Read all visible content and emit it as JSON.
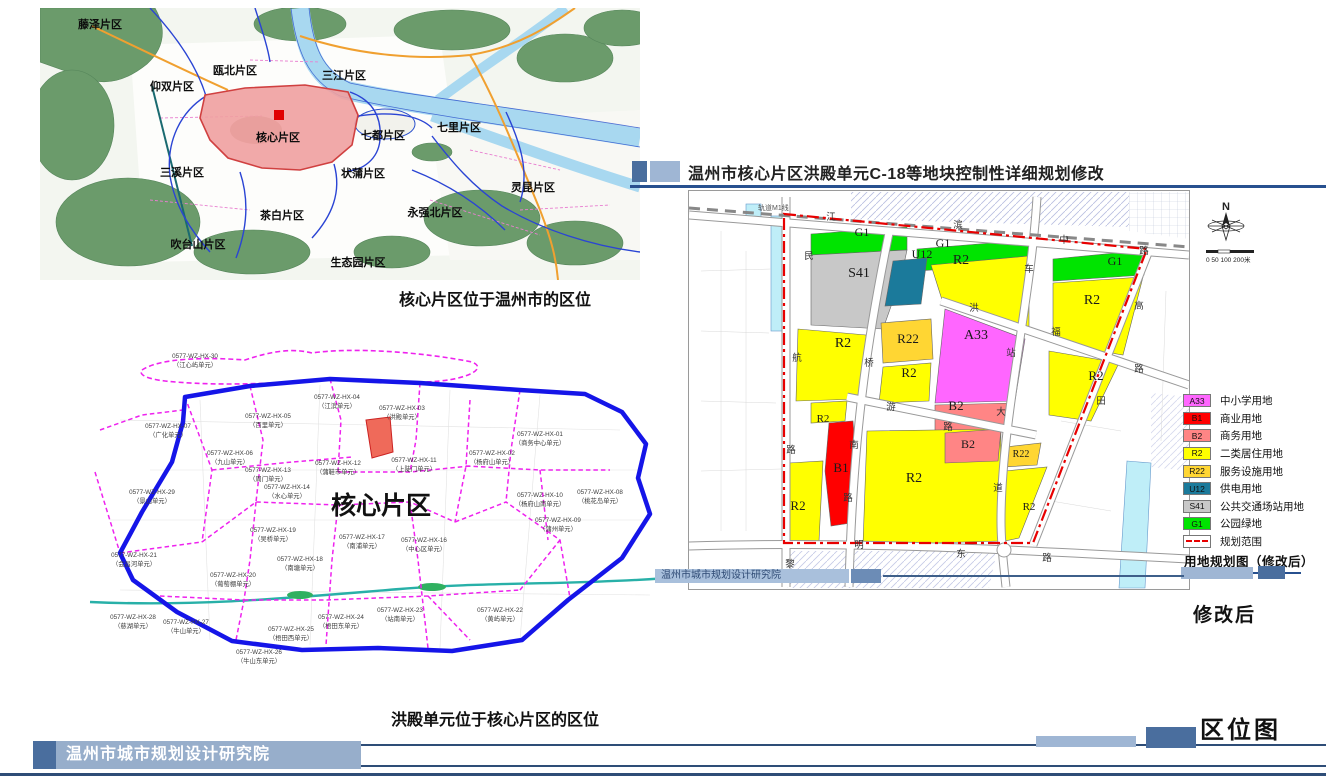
{
  "header": {
    "title": "温州市核心片区洪殿单元C-18等地块控制性详细规划修改"
  },
  "captions": {
    "region_map": "核心片区位于温州市的区位",
    "unit_map": "洪殿单元位于核心片区的区位"
  },
  "region_map": {
    "labels": [
      {
        "text": "藤泽片区",
        "x": 100,
        "y": 28
      },
      {
        "text": "瓯北片区",
        "x": 235,
        "y": 74
      },
      {
        "text": "三江片区",
        "x": 344,
        "y": 79
      },
      {
        "text": "仰双片区",
        "x": 172,
        "y": 90
      },
      {
        "text": "核心片区",
        "x": 278,
        "y": 141
      },
      {
        "text": "七都片区",
        "x": 383,
        "y": 139
      },
      {
        "text": "七里片区",
        "x": 459,
        "y": 131
      },
      {
        "text": "三溪片区",
        "x": 182,
        "y": 176
      },
      {
        "text": "状蒲片区",
        "x": 363,
        "y": 177
      },
      {
        "text": "灵昆片区",
        "x": 533,
        "y": 191
      },
      {
        "text": "茶白片区",
        "x": 282,
        "y": 219
      },
      {
        "text": "永强北片区",
        "x": 435,
        "y": 216
      },
      {
        "text": "吹台山片区",
        "x": 198,
        "y": 248
      },
      {
        "text": "生态园片区",
        "x": 358,
        "y": 266
      }
    ]
  },
  "unit_map": {
    "big_label": "核心片区",
    "units": [
      {
        "code": "0577-WZ-HX-30",
        "name": "（江心屿单元）",
        "x": 195,
        "y": 358
      },
      {
        "code": "0577-WZ-HX-07",
        "name": "（广化单元）",
        "x": 168,
        "y": 428
      },
      {
        "code": "0577-WZ-HX-05",
        "name": "（百里单元）",
        "x": 268,
        "y": 418
      },
      {
        "code": "0577-WZ-HX-04",
        "name": "（江滨单元）",
        "x": 337,
        "y": 399
      },
      {
        "code": "0577-WZ-HX-03",
        "name": "（洪殿单元）",
        "x": 402,
        "y": 410
      },
      {
        "code": "0577-WZ-HX-06",
        "name": "（九山单元）",
        "x": 230,
        "y": 455
      },
      {
        "code": "0577-WZ-HX-12",
        "name": "（蒲鞋市单元）",
        "x": 338,
        "y": 465
      },
      {
        "code": "0577-WZ-HX-11",
        "name": "（上陡门单元）",
        "x": 414,
        "y": 462
      },
      {
        "code": "0577-WZ-HX-02",
        "name": "（杨府山单元）",
        "x": 492,
        "y": 455
      },
      {
        "code": "0577-WZ-HX-01",
        "name": "（商务中心单元）",
        "x": 540,
        "y": 436
      },
      {
        "code": "0577-WZ-HX-10",
        "name": "（杨府山南单元）",
        "x": 540,
        "y": 497
      },
      {
        "code": "0577-WZ-HX-08",
        "name": "（桃花岛单元）",
        "x": 600,
        "y": 494
      },
      {
        "code": "0577-WZ-HX-09",
        "name": "（蒲州单元）",
        "x": 558,
        "y": 522
      },
      {
        "code": "0577-WZ-HX-13",
        "name": "（周门单元）",
        "x": 268,
        "y": 472
      },
      {
        "code": "0577-WZ-HX-14",
        "name": "（水心单元）",
        "x": 287,
        "y": 489
      },
      {
        "code": "0577-WZ-HX-29",
        "name": "（景山单元）",
        "x": 152,
        "y": 494
      },
      {
        "code": "0577-WZ-HX-21",
        "name": "（会昌河单元）",
        "x": 134,
        "y": 557
      },
      {
        "code": "0577-WZ-HX-19",
        "name": "（吴桥单元）",
        "x": 273,
        "y": 532
      },
      {
        "code": "0577-WZ-HX-17",
        "name": "（南浦单元）",
        "x": 362,
        "y": 539
      },
      {
        "code": "0577-WZ-HX-16",
        "name": "（中心区单元）",
        "x": 424,
        "y": 542
      },
      {
        "code": "0577-WZ-HX-18",
        "name": "（南塘单元）",
        "x": 300,
        "y": 561
      },
      {
        "code": "0577-WZ-HX-20",
        "name": "（葡萄棚单元）",
        "x": 233,
        "y": 577
      },
      {
        "code": "0577-WZ-HX-27",
        "name": "（牛山单元）",
        "x": 186,
        "y": 624
      },
      {
        "code": "0577-WZ-HX-25",
        "name": "（梧田西单元）",
        "x": 291,
        "y": 631
      },
      {
        "code": "0577-WZ-HX-24",
        "name": "（梧田东单元）",
        "x": 341,
        "y": 619
      },
      {
        "code": "0577-WZ-HX-26",
        "name": "（牛山东单元）",
        "x": 259,
        "y": 654
      },
      {
        "code": "0577-WZ-HX-23",
        "name": "（站南单元）",
        "x": 400,
        "y": 612
      },
      {
        "code": "0577-WZ-HX-22",
        "name": "（黄屿单元）",
        "x": 500,
        "y": 612
      },
      {
        "code": "0577-WZ-HX-28",
        "name": "（慈湖单元）",
        "x": 133,
        "y": 619
      }
    ]
  },
  "zoning_map": {
    "rail_label": "轨道M1线",
    "compass": {
      "n": "N",
      "scale": "0 50 100 200米"
    },
    "blocks": [
      {
        "code": "G1",
        "x": 861,
        "y": 235,
        "s": 12
      },
      {
        "code": "G1",
        "x": 942,
        "y": 246,
        "s": 12
      },
      {
        "code": "G1",
        "x": 1114,
        "y": 264,
        "s": 12
      },
      {
        "code": "S41",
        "x": 858,
        "y": 276,
        "s": 14
      },
      {
        "code": "U12",
        "x": 921,
        "y": 257,
        "s": 12
      },
      {
        "code": "R2",
        "x": 960,
        "y": 263,
        "s": 14
      },
      {
        "code": "R2",
        "x": 1091,
        "y": 303,
        "s": 14
      },
      {
        "code": "R22",
        "x": 907,
        "y": 342,
        "s": 13
      },
      {
        "code": "A33",
        "x": 975,
        "y": 338,
        "s": 14
      },
      {
        "code": "R2",
        "x": 842,
        "y": 346,
        "s": 14
      },
      {
        "code": "R2",
        "x": 908,
        "y": 376,
        "s": 13
      },
      {
        "code": "B2",
        "x": 955,
        "y": 409,
        "s": 13
      },
      {
        "code": "B2",
        "x": 967,
        "y": 447,
        "s": 12
      },
      {
        "code": "R22",
        "x": 1020,
        "y": 456,
        "s": 10
      },
      {
        "code": "B1",
        "x": 840,
        "y": 471,
        "s": 13
      },
      {
        "code": "R2",
        "x": 822,
        "y": 421,
        "s": 11
      },
      {
        "code": "R2",
        "x": 797,
        "y": 509,
        "s": 13
      },
      {
        "code": "R2",
        "x": 913,
        "y": 481,
        "s": 14
      },
      {
        "code": "R2",
        "x": 1095,
        "y": 379,
        "s": 13
      },
      {
        "code": "R2",
        "x": 1028,
        "y": 509,
        "s": 11
      }
    ],
    "road_chars": [
      {
        "ch": "江",
        "x": 830,
        "y": 219
      },
      {
        "ch": "滨",
        "x": 957,
        "y": 227
      },
      {
        "ch": "中",
        "x": 1063,
        "y": 242
      },
      {
        "ch": "路",
        "x": 1143,
        "y": 253
      },
      {
        "ch": "民",
        "x": 808,
        "y": 258
      },
      {
        "ch": "航",
        "x": 796,
        "y": 360
      },
      {
        "ch": "路",
        "x": 790,
        "y": 452
      },
      {
        "ch": "桥",
        "x": 868,
        "y": 365
      },
      {
        "ch": "南",
        "x": 853,
        "y": 447
      },
      {
        "ch": "路",
        "x": 847,
        "y": 500
      },
      {
        "ch": "车",
        "x": 1028,
        "y": 271
      },
      {
        "ch": "站",
        "x": 1010,
        "y": 355
      },
      {
        "ch": "大",
        "x": 1000,
        "y": 414
      },
      {
        "ch": "道",
        "x": 997,
        "y": 490
      },
      {
        "ch": "洪",
        "x": 973,
        "y": 310
      },
      {
        "ch": "福",
        "x": 1055,
        "y": 334
      },
      {
        "ch": "路",
        "x": 1138,
        "y": 371
      },
      {
        "ch": "游",
        "x": 890,
        "y": 409
      },
      {
        "ch": "路",
        "x": 947,
        "y": 429
      },
      {
        "ch": "黎",
        "x": 789,
        "y": 566
      },
      {
        "ch": "明",
        "x": 858,
        "y": 547
      },
      {
        "ch": "东",
        "x": 960,
        "y": 556
      },
      {
        "ch": "路",
        "x": 1046,
        "y": 560
      },
      {
        "ch": "高",
        "x": 1138,
        "y": 308
      },
      {
        "ch": "田",
        "x": 1100,
        "y": 403
      }
    ],
    "legend": {
      "items": [
        {
          "code": "A33",
          "color": "#FF66FF",
          "label": "中小学用地"
        },
        {
          "code": "B1",
          "color": "#FF0000",
          "label": "商业用地"
        },
        {
          "code": "B2",
          "color": "#FF8585",
          "label": "商务用地"
        },
        {
          "code": "R2",
          "color": "#FFFF00",
          "label": "二类居住用地"
        },
        {
          "code": "R22",
          "color": "#FFD633",
          "label": "服务设施用地"
        },
        {
          "code": "U12",
          "color": "#1B7A9B",
          "label": "供电用地"
        },
        {
          "code": "S41",
          "color": "#C8C8C8",
          "label": "公共交通场站用地"
        },
        {
          "code": "G1",
          "color": "#00E400",
          "label": "公园绿地"
        }
      ],
      "boundary_label": "规划范围",
      "caption": "用地规划图（修改后）"
    },
    "footer_org": "温州市城市规划设计研究院",
    "after_label": "修改后"
  },
  "page_footer": {
    "org": "温州市城市规划设计研究院",
    "map_type": "区位图"
  },
  "colors": {
    "bar_dark": "#4A6E9E",
    "bar_light": "#9FB6D4",
    "line_blue": "#27508F",
    "boundary_red": "#E80000",
    "unit_dash": "#EE22EE",
    "core_fill": "#F0A0A0"
  }
}
